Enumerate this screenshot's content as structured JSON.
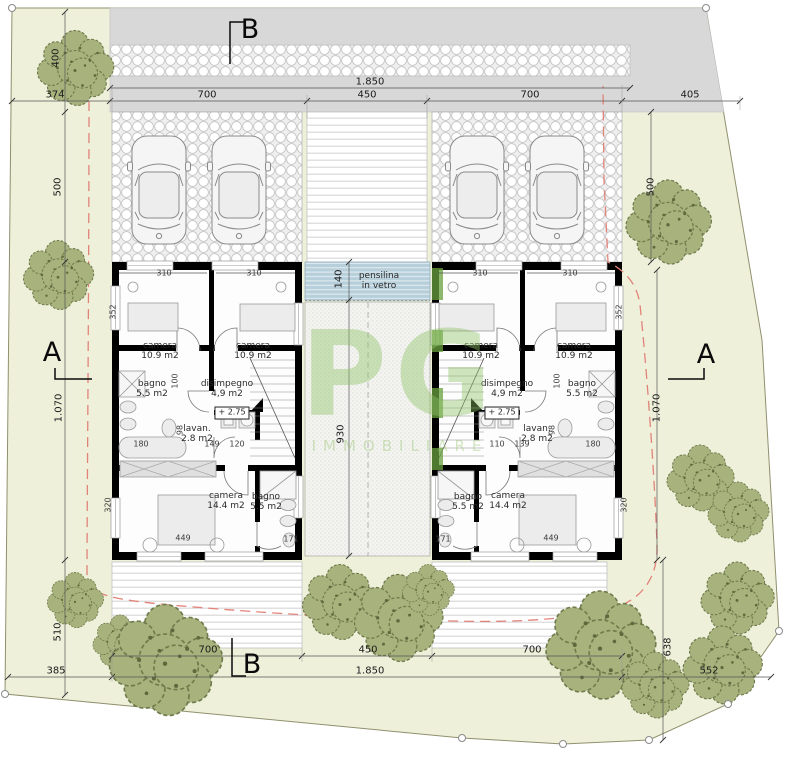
{
  "title": "Site / floor plan drawing",
  "watermark": {
    "text": "PG",
    "subtext": "IMMOBILIARE"
  },
  "colors": {
    "parcel": "#eef0da",
    "road": "#d8d8d8",
    "canopy_glass": "#b7cfda",
    "tree": "#a8b27d",
    "setback_line": "#e2837a",
    "wall": "#000000",
    "logo_green": "#6aa23f"
  },
  "labels": [
    {
      "text": "B",
      "x": 250,
      "y": 30,
      "cls": "sec",
      "name": "section-marker-b-top"
    },
    {
      "text": "B",
      "x": 252,
      "y": 665,
      "cls": "sec",
      "name": "section-marker-b-bottom"
    },
    {
      "text": "A",
      "x": 52,
      "y": 353,
      "cls": "sec",
      "name": "section-marker-a-left"
    },
    {
      "text": "A",
      "x": 706,
      "y": 355,
      "cls": "sec",
      "name": "section-marker-a-right"
    },
    {
      "text": "1.850",
      "x": 370,
      "y": 82,
      "cls": "dim"
    },
    {
      "text": "700",
      "x": 207,
      "y": 95,
      "cls": "dim"
    },
    {
      "text": "450",
      "x": 367,
      "y": 95,
      "cls": "dim"
    },
    {
      "text": "700",
      "x": 530,
      "y": 95,
      "cls": "dim"
    },
    {
      "text": "405",
      "x": 690,
      "y": 95,
      "cls": "dim"
    },
    {
      "text": "374",
      "x": 55,
      "y": 95,
      "cls": "dim"
    },
    {
      "text": "400",
      "x": 56,
      "y": 58,
      "cls": "dim",
      "rot": true
    },
    {
      "text": "500",
      "x": 58,
      "y": 187,
      "cls": "dim",
      "rot": true
    },
    {
      "text": "1.070",
      "x": 59,
      "y": 408,
      "cls": "dim",
      "rot": true
    },
    {
      "text": "510",
      "x": 58,
      "y": 632,
      "cls": "dim",
      "rot": true
    },
    {
      "text": "385",
      "x": 56,
      "y": 671,
      "cls": "dim"
    },
    {
      "text": "500",
      "x": 651,
      "y": 187,
      "cls": "dim",
      "rot": true
    },
    {
      "text": "1.070",
      "x": 657,
      "y": 408,
      "cls": "dim",
      "rot": true
    },
    {
      "text": "638",
      "x": 668,
      "y": 647,
      "cls": "dim",
      "rot": true
    },
    {
      "text": "552",
      "x": 709,
      "y": 671,
      "cls": "dim"
    },
    {
      "text": "700",
      "x": 208,
      "y": 650,
      "cls": "dim"
    },
    {
      "text": "450",
      "x": 368,
      "y": 650,
      "cls": "dim"
    },
    {
      "text": "700",
      "x": 532,
      "y": 650,
      "cls": "dim"
    },
    {
      "text": "1.850",
      "x": 370,
      "y": 671,
      "cls": "dim"
    },
    {
      "text": "140",
      "x": 339,
      "y": 279,
      "cls": "dim",
      "rot": true
    },
    {
      "text": "930",
      "x": 341,
      "y": 434,
      "cls": "dim",
      "rot": true
    },
    {
      "text": "310",
      "x": 164,
      "y": 274,
      "cls": "sdim"
    },
    {
      "text": "310",
      "x": 254,
      "y": 274,
      "cls": "sdim"
    },
    {
      "text": "310",
      "x": 480,
      "y": 274,
      "cls": "sdim"
    },
    {
      "text": "310",
      "x": 570,
      "y": 274,
      "cls": "sdim"
    },
    {
      "text": "352",
      "x": 114,
      "y": 312,
      "cls": "sdim",
      "rot": true
    },
    {
      "text": "352",
      "x": 620,
      "y": 312,
      "cls": "sdim",
      "rot": true
    },
    {
      "text": "100",
      "x": 176,
      "y": 381,
      "cls": "sdim",
      "rot": true
    },
    {
      "text": "100",
      "x": 558,
      "y": 381,
      "cls": "sdim",
      "rot": true
    },
    {
      "text": "98",
      "x": 181,
      "y": 430,
      "cls": "sdim",
      "rot": true
    },
    {
      "text": "98",
      "x": 553,
      "y": 430,
      "cls": "sdim",
      "rot": true
    },
    {
      "text": "180",
      "x": 141,
      "y": 445,
      "cls": "sdim"
    },
    {
      "text": "180",
      "x": 593,
      "y": 445,
      "cls": "sdim"
    },
    {
      "text": "149",
      "x": 212,
      "y": 445,
      "cls": "sdim"
    },
    {
      "text": "120",
      "x": 237,
      "y": 445,
      "cls": "sdim"
    },
    {
      "text": "139",
      "x": 522,
      "y": 445,
      "cls": "sdim"
    },
    {
      "text": "110",
      "x": 497,
      "y": 445,
      "cls": "sdim"
    },
    {
      "text": "320",
      "x": 109,
      "y": 505,
      "cls": "sdim",
      "rot": true
    },
    {
      "text": "320",
      "x": 625,
      "y": 505,
      "cls": "sdim",
      "rot": true
    },
    {
      "text": "449",
      "x": 183,
      "y": 539,
      "cls": "sdim"
    },
    {
      "text": "449",
      "x": 551,
      "y": 539,
      "cls": "sdim"
    },
    {
      "text": "171",
      "x": 291,
      "y": 540,
      "cls": "sdim"
    },
    {
      "text": "171",
      "x": 443,
      "y": 540,
      "cls": "sdim"
    },
    {
      "text": "camera\n10.9 m2",
      "x": 160,
      "y": 351,
      "cls": "room"
    },
    {
      "text": "camera\n10.9 m2",
      "x": 253,
      "y": 351,
      "cls": "room"
    },
    {
      "text": "camera\n10.9 m2",
      "x": 481,
      "y": 351,
      "cls": "room"
    },
    {
      "text": "camera\n10.9 m2",
      "x": 574,
      "y": 351,
      "cls": "room"
    },
    {
      "text": "bagno\n5.5 m2",
      "x": 152,
      "y": 389,
      "cls": "room"
    },
    {
      "text": "bagno\n5.5 m2",
      "x": 582,
      "y": 389,
      "cls": "room"
    },
    {
      "text": "disimpegno\n4,9 m2",
      "x": 227,
      "y": 389,
      "cls": "room"
    },
    {
      "text": "disimpegno\n4,9 m2",
      "x": 507,
      "y": 389,
      "cls": "room"
    },
    {
      "text": "lavan.\n2.8 m2",
      "x": 197,
      "y": 434,
      "cls": "room"
    },
    {
      "text": "lavan.\n2.8 m2",
      "x": 537,
      "y": 434,
      "cls": "room"
    },
    {
      "text": "+ 2.75",
      "x": 232,
      "y": 413,
      "cls": "lvl"
    },
    {
      "text": "+ 2.75",
      "x": 502,
      "y": 413,
      "cls": "lvl"
    },
    {
      "text": "camera\n14.4 m2",
      "x": 226,
      "y": 501,
      "cls": "room"
    },
    {
      "text": "camera\n14.4 m2",
      "x": 508,
      "y": 501,
      "cls": "room"
    },
    {
      "text": "bagno\n5.5 m2",
      "x": 266,
      "y": 502,
      "cls": "room"
    },
    {
      "text": "bagno\n5.5 m2",
      "x": 468,
      "y": 502,
      "cls": "room"
    },
    {
      "text": "pensilina\nin vetro",
      "x": 379,
      "y": 281,
      "cls": "room"
    }
  ]
}
